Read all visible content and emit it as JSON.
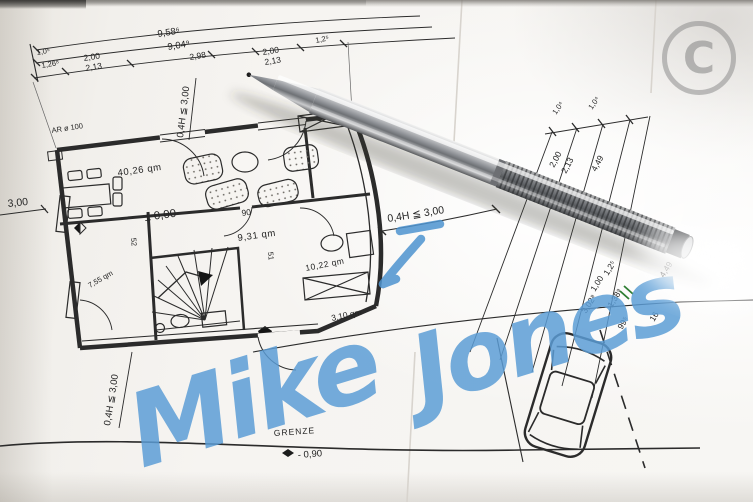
{
  "watermark": {
    "letter": "C"
  },
  "signature": {
    "first": "Mike",
    "last": "Jones"
  },
  "plan": {
    "rooms": [
      "40,26 qm",
      "9,31 qm",
      "10,22 qm",
      "7,55 qm",
      "3,10 qm"
    ],
    "level": "± 0,00",
    "vent": "AR ø 100",
    "wall_widths": [
      "90",
      "52",
      "51"
    ]
  },
  "dims": {
    "top_totals": [
      "9,58⁶",
      "9,04⁹"
    ],
    "top_segs": [
      "1,0⁵",
      "1,26⁸",
      "2,00",
      "2,13",
      "2,98",
      "2,00",
      "2,13",
      "1,2⁵"
    ],
    "left_height": "3,00",
    "setbacks": [
      "0,4H ≦ 3,00",
      "0,4H ≦ 3,00",
      "0,4H ≦ 3,00"
    ],
    "right_chain": [
      "1,0⁴",
      "1,0⁴",
      "2,00",
      "2,13",
      "4,49",
      "1,00",
      "1,2⁵",
      "1,38⁹",
      "3,02⁸",
      "99⁵",
      "16",
      "4,49"
    ]
  },
  "site": {
    "boundary": "GRENZE",
    "level": "- 0,90"
  },
  "colors": {
    "ink": "#2b2b2b",
    "marker_blue": "#5b9dd6",
    "paper": "#f4f2ee",
    "watermark_gray": "#8f8f8f",
    "survey_tick_green": "#2e7d32"
  }
}
